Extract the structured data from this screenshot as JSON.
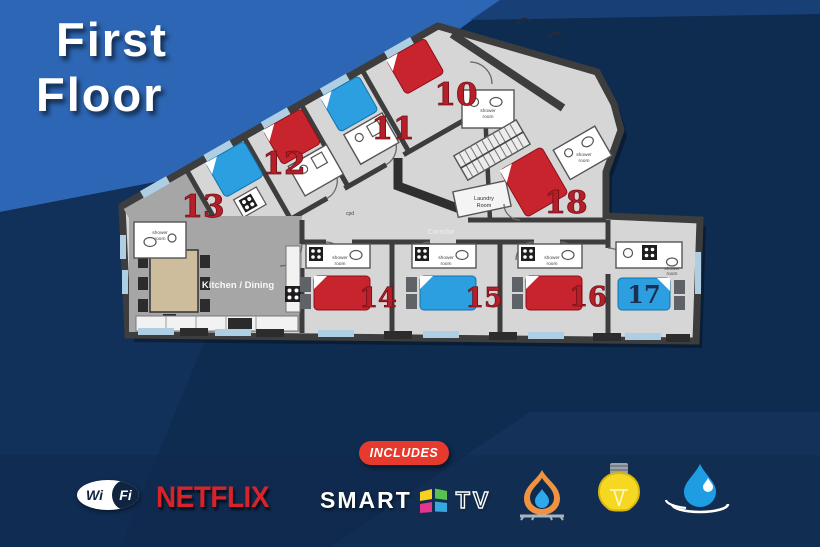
{
  "title": {
    "line1": "First",
    "line2": "Floor"
  },
  "plan": {
    "rooms": [
      {
        "number": "10",
        "bed": "red"
      },
      {
        "number": "11",
        "bed": "blue"
      },
      {
        "number": "12",
        "bed": "red"
      },
      {
        "number": "13",
        "bed": "blue"
      },
      {
        "number": "14",
        "bed": "red"
      },
      {
        "number": "15",
        "bed": "blue"
      },
      {
        "number": "16",
        "bed": "red"
      },
      {
        "number": "17",
        "bed": "blue"
      },
      {
        "number": "18",
        "bed": "red"
      }
    ],
    "labels": {
      "kitchen": "Kitchen / Dining",
      "corridor": "Corridor",
      "laundry_line1": "Laundry",
      "laundry_line2": "Room",
      "shower_line1": "shower",
      "shower_line2": "room",
      "cupboard": "cpd"
    }
  },
  "footer": {
    "includes_badge": "INCLUDES",
    "wifi": {
      "left": "Wi",
      "right": "Fi"
    },
    "netflix": "NETFLIX",
    "smart_tv": {
      "smart": "SMART",
      "tv": "TV"
    },
    "amenities": [
      {
        "name": "gas-flame"
      },
      {
        "name": "light-bulb"
      },
      {
        "name": "water-drop"
      }
    ]
  },
  "colors": {
    "bed_red": "#c8242e",
    "bed_blue": "#2b9fe0",
    "room_number_red": "#b51f28",
    "room_number_dark": "#1b2f55",
    "background_navy": "#0e2b50",
    "accent_bright_blue": "#2d66b4",
    "netflix_red": "#d8232a",
    "includes_red": "#e63a2e",
    "plan_floor_gray": "#d6d6d6",
    "wall_dark_gray": "#3d3d3d",
    "window_blue": "#aecfe3"
  }
}
